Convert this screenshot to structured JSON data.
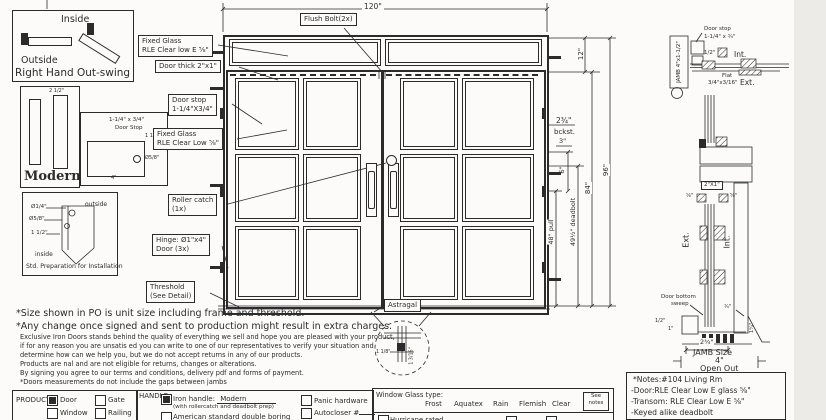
{
  "swing": {
    "inside": "Inside",
    "outside": "Outside",
    "caption": "Right Hand Out-swing"
  },
  "modern": {
    "title": "Modern",
    "dim_top": "2 1/2\""
  },
  "doorstop_detail": {
    "line1": "1-1/4\" x 3/4\"",
    "line2": "Door Stop",
    "dim1": "1 1/2\"",
    "dim2": "Ø5/8\"",
    "dim3": "4\""
  },
  "std_prep": {
    "dia_small": "Ø1/4\"",
    "dia_big": "Ø5/8\"",
    "dim": "1 1/2\"",
    "outside": "outside",
    "inside": "inside",
    "caption": "Std. Preparation for Installation"
  },
  "callouts": {
    "flush_bolt": "Flush Bolt(2x)",
    "fixed_glass_top_1": "Fixed Glass",
    "fixed_glass_top_2": "RLE Clear low E ⅝\"",
    "door_thick": "Door thick 2\"x1\"",
    "door_stop_1": "Door stop",
    "door_stop_2": "1-1/4\"X3/4\"",
    "fixed_glass_door_1": "Fixed Glass",
    "fixed_glass_door_2": "RLE Clear Low ⅝\"",
    "roller_catch_1": "Roller catch",
    "roller_catch_2": "(1x)",
    "hinge_1": "Hinge: Ø1\"x4\"",
    "hinge_2": "Door (3x)",
    "threshold_1": "Threshold",
    "threshold_2": "(See Detail)",
    "astragal": "Astragal"
  },
  "dims": {
    "width_total": "120\"",
    "transom": "12\"",
    "door_height": "84\"",
    "height_total": "96\"",
    "backset_1": "2¾\"",
    "backset_2": "bckst.",
    "d3": "3\"",
    "d6": "6\"",
    "pull": "48\" pull",
    "deadbolt": "49½\" deadbolt",
    "astragal_w": "1 1/8\"",
    "astragal_h": "1 3/16\""
  },
  "jamb_plan": {
    "jamb": "JAMB 4\"x1-1/2\"",
    "door_stop_1": "Door stop",
    "door_stop_2": "1-1/4\" x ¾\"",
    "half": "1/2\"",
    "int": "Int.",
    "flat_1": "Flat",
    "flat_2": "3/4\"x3/16\"",
    "ext": "Ext."
  },
  "section": {
    "tube": "2\"X1\"",
    "left_frac": "⅝\"",
    "right_frac": "⅝\"",
    "ext": "Ext.",
    "int": "Int.",
    "sweep_1": "Door bottom",
    "sweep_2": "sweep",
    "half": "1/2\"",
    "one": "1\"",
    "three_quarter": "¾\"",
    "one_quarter": "1¼\"",
    "jamb_depth": "2¾\"",
    "jamb_size_1": "JAMB Size",
    "jamb_size_2": "4\"",
    "jamb_size_3": "Open Out"
  },
  "disclaimer": {
    "line1": "*Size shown in PO is unit size including frame and threshold.",
    "line2": "*Any change once signed and sent to production might result in extra charges.",
    "small": [
      "Exclusive Iron Doors stands behind the quality of everything we sell and hope you are pleased with your product,",
      "if for any reason you are unsatis ed you can write to one of our representatives to verify your situation and",
      "determine how can we help you, but we do not accept returns in any of our products.",
      "Products are  nal and are not eligible for returns, changes or alterations.",
      "By signing you agree to our terms and conditions, delivery pdf and forms of payment.",
      "*Doors measurements do not include the gaps between jambs"
    ]
  },
  "notes_box": {
    "line1": "*Notes:#104 Living Rm",
    "line2": "-Door:RLE Clear Low E glass ⅝\"",
    "line3": "-Transom: RLE Clear Low E ⅝\"",
    "line4": "-Keyed alike deadbolt"
  },
  "form": {
    "product": {
      "label": "PRODUCT:",
      "options": [
        {
          "label": "Door",
          "checked": true
        },
        {
          "label": "Gate",
          "checked": false
        },
        {
          "label": "Window",
          "checked": false
        },
        {
          "label": "Railing",
          "checked": false
        }
      ]
    },
    "handle": {
      "label": "HANDLE",
      "iron": {
        "checked": true,
        "label": "Iron handle:",
        "value": "Modern",
        "note": "(with rollercatch and deadbolt prep)"
      },
      "american": {
        "checked": false,
        "label": "American standard double boring"
      },
      "panic": {
        "checked": false,
        "label": "Panic hardware"
      },
      "autocloser": {
        "checked": false,
        "label": "Autocloser #"
      }
    },
    "glass": {
      "label": "Window Glass type:",
      "options": [
        "Frost",
        "Aquatex",
        "Rain",
        "Flemish",
        "Clear"
      ],
      "see_notes_1": "See",
      "see_notes_2": "notes",
      "hurricane": {
        "checked": false,
        "label": "Hurricane rated"
      }
    }
  }
}
